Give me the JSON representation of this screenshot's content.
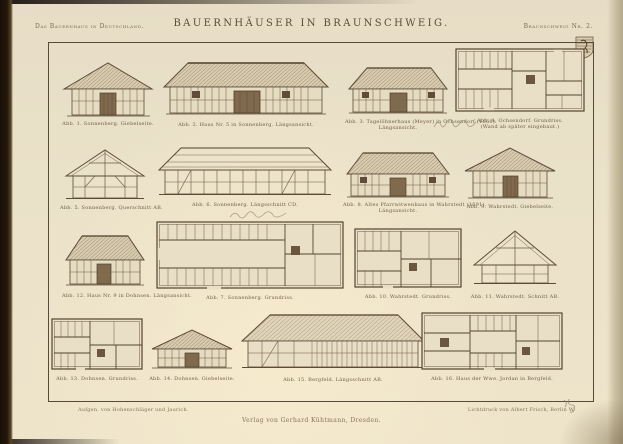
{
  "page": {
    "series_title": "Das Bauernhaus in Deutschland.",
    "plate_title": "BAUERNHÄUSER IN BRAUNSCHWEIG.",
    "plate_number": "Braunschweig Nr. 2.",
    "crest_icon": "braunschweig-crest",
    "ink_color": "#5e4c39",
    "paper_color": "#eae1c9"
  },
  "figures": [
    {
      "id": "abb1",
      "caption": "Abb. 1.  Sonnenberg.  Giebelseite."
    },
    {
      "id": "abb2",
      "caption": "Abb. 2.  Haus Nr. 5 in Sonnenberg.  Längsansicht."
    },
    {
      "id": "abb3",
      "caption": "Abb. 3.  Tagelöhnerhaus (Meyer) in Ochsendorf (1666).",
      "caption2": "Längsansicht."
    },
    {
      "id": "abb4",
      "caption": "Abb. 4.  Ochsendorf.  Grundriss.",
      "caption2": "(Wand ab später eingebaut.)"
    },
    {
      "id": "abb5",
      "caption": "Abb. 5.  Sonnenberg.  Querschnitt AB."
    },
    {
      "id": "abb6",
      "caption": "Abb. 6.  Sonnenberg.  Längsschnitt CD."
    },
    {
      "id": "abb8",
      "caption": "Abb. 8.  Altes Pfarrwitwenhaus in Wahrstedt (1691).",
      "caption2": "Längsansicht."
    },
    {
      "id": "abb9",
      "caption": "Abb. 9.  Wahrstedt.  Giebelseite."
    },
    {
      "id": "abb12",
      "caption": "Abb. 12.  Haus Nr. 9 in Dohnsen.  Längsansicht."
    },
    {
      "id": "abb7",
      "caption": "Abb. 7.  Sonnenberg.  Grundriss."
    },
    {
      "id": "abb10",
      "caption": "Abb. 10.  Wahrstedt.  Grundriss."
    },
    {
      "id": "abb11",
      "caption": "Abb. 11.  Wahrstedt.  Schnitt AB."
    },
    {
      "id": "abb13",
      "caption": "Abb. 13.  Dohnsen.  Grundriss."
    },
    {
      "id": "abb14",
      "caption": "Abb. 14.  Dohnsen.  Giebelseite."
    },
    {
      "id": "abb15",
      "caption": "Abb. 15.  Bergfeld.  Längsschnitt AB."
    },
    {
      "id": "abb16",
      "caption": "Abb. 16.  Haus der Wwe. Jordan in Bergfeld."
    }
  ],
  "imprint": {
    "left": "Aufgen. von Hohenschläger und Jaurich.",
    "center": "Verlag von Gerhard Kühtmann, Dresden.",
    "right": "Lichtdruck von Albert Frisch, Berlin W."
  }
}
